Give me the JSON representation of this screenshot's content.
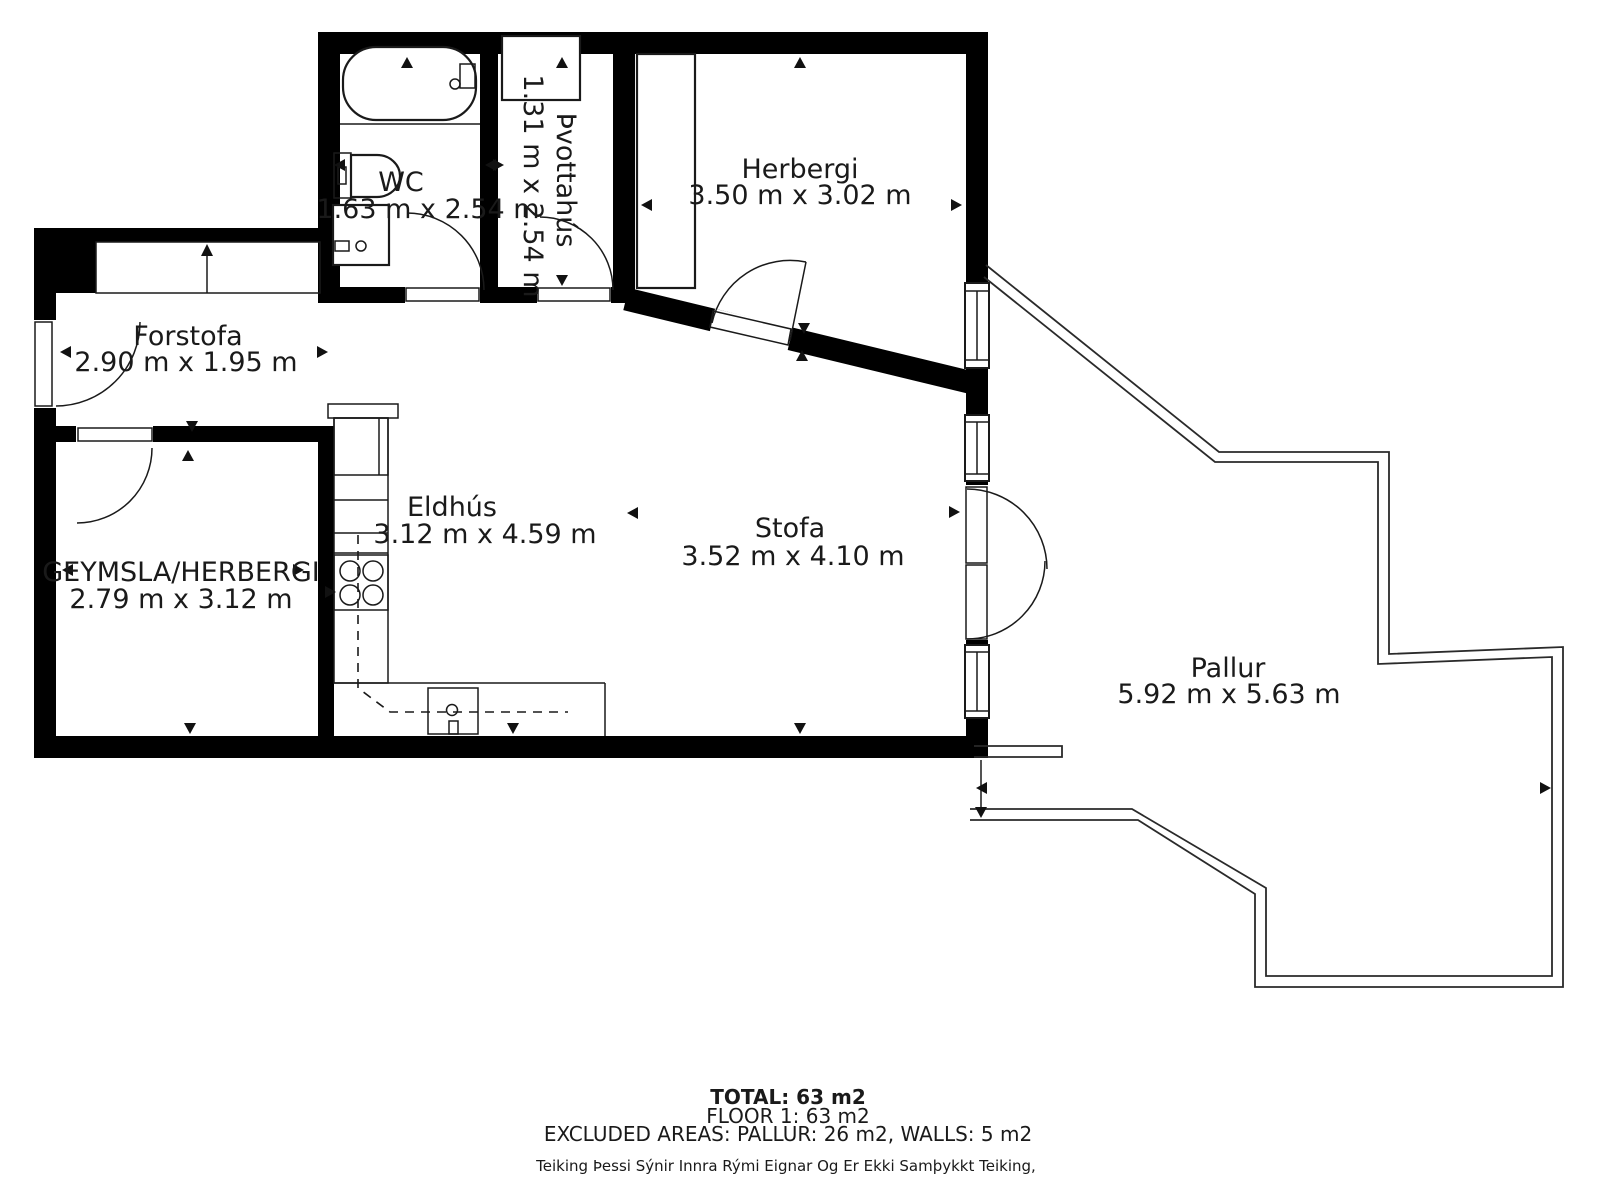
{
  "rooms": {
    "wc": {
      "name": "WC",
      "dims": "1.63 m x 2.54 m"
    },
    "laundry": {
      "name": "Þvottahús",
      "dims": "1.31 m x 2.54 m"
    },
    "bedroom": {
      "name": "Herbergi",
      "dims": "3.50 m x 3.02 m"
    },
    "hall": {
      "name": "Forstofa",
      "dims": "2.90 m x 1.95 m"
    },
    "storage": {
      "name": "GEYMSLA/HERBERGI",
      "dims": "2.79 m x 3.12 m"
    },
    "kitchen": {
      "name": "Eldhús",
      "dims": "3.12 m x 4.59 m"
    },
    "living": {
      "name": "Stofa",
      "dims": "3.52 m x 4.10 m"
    },
    "deck": {
      "name": "Pallur",
      "dims": "5.92 m x 5.63 m"
    }
  },
  "summary": {
    "total": "TOTAL: 63 m2",
    "floor": "FLOOR 1: 63 m2",
    "excluded": "EXCLUDED AREAS: PALLUR: 26 m2, WALLS: 5 m2",
    "disclaimer": "Teiking Þessi Sýnir Innra Rými Eignar Og Er Ekki Samþykkt Teiking,"
  },
  "colors": {
    "wall": "#000000",
    "line": "#1a1a1a",
    "background": "#ffffff"
  }
}
